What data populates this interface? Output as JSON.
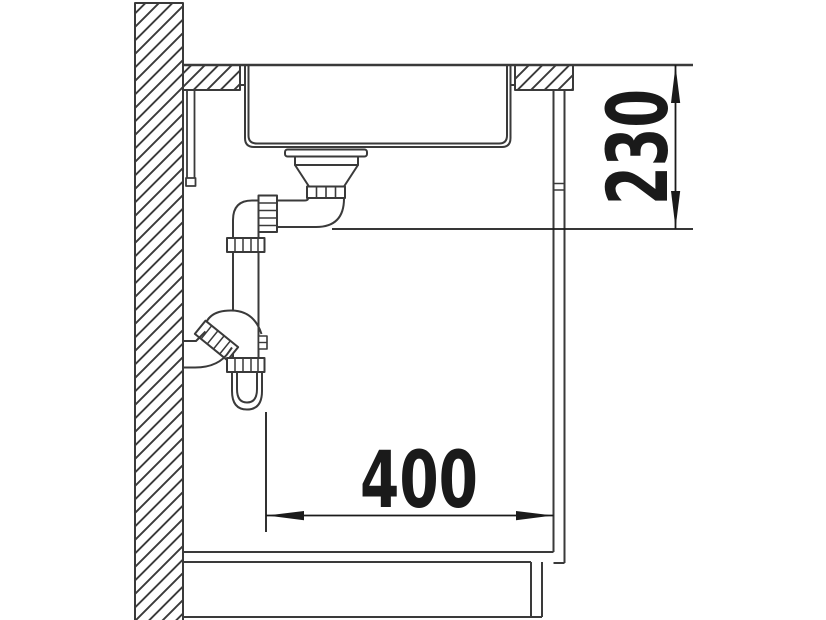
{
  "diagram": {
    "title": "sink-installation-side-view",
    "dimensions": {
      "depth": {
        "label": "230",
        "orientation": "vertical"
      },
      "offset": {
        "label": "400",
        "orientation": "horizontal"
      }
    },
    "colors": {
      "line": "#3a3a3a",
      "dim": "#1a1a1a",
      "background": "#ffffff"
    }
  }
}
